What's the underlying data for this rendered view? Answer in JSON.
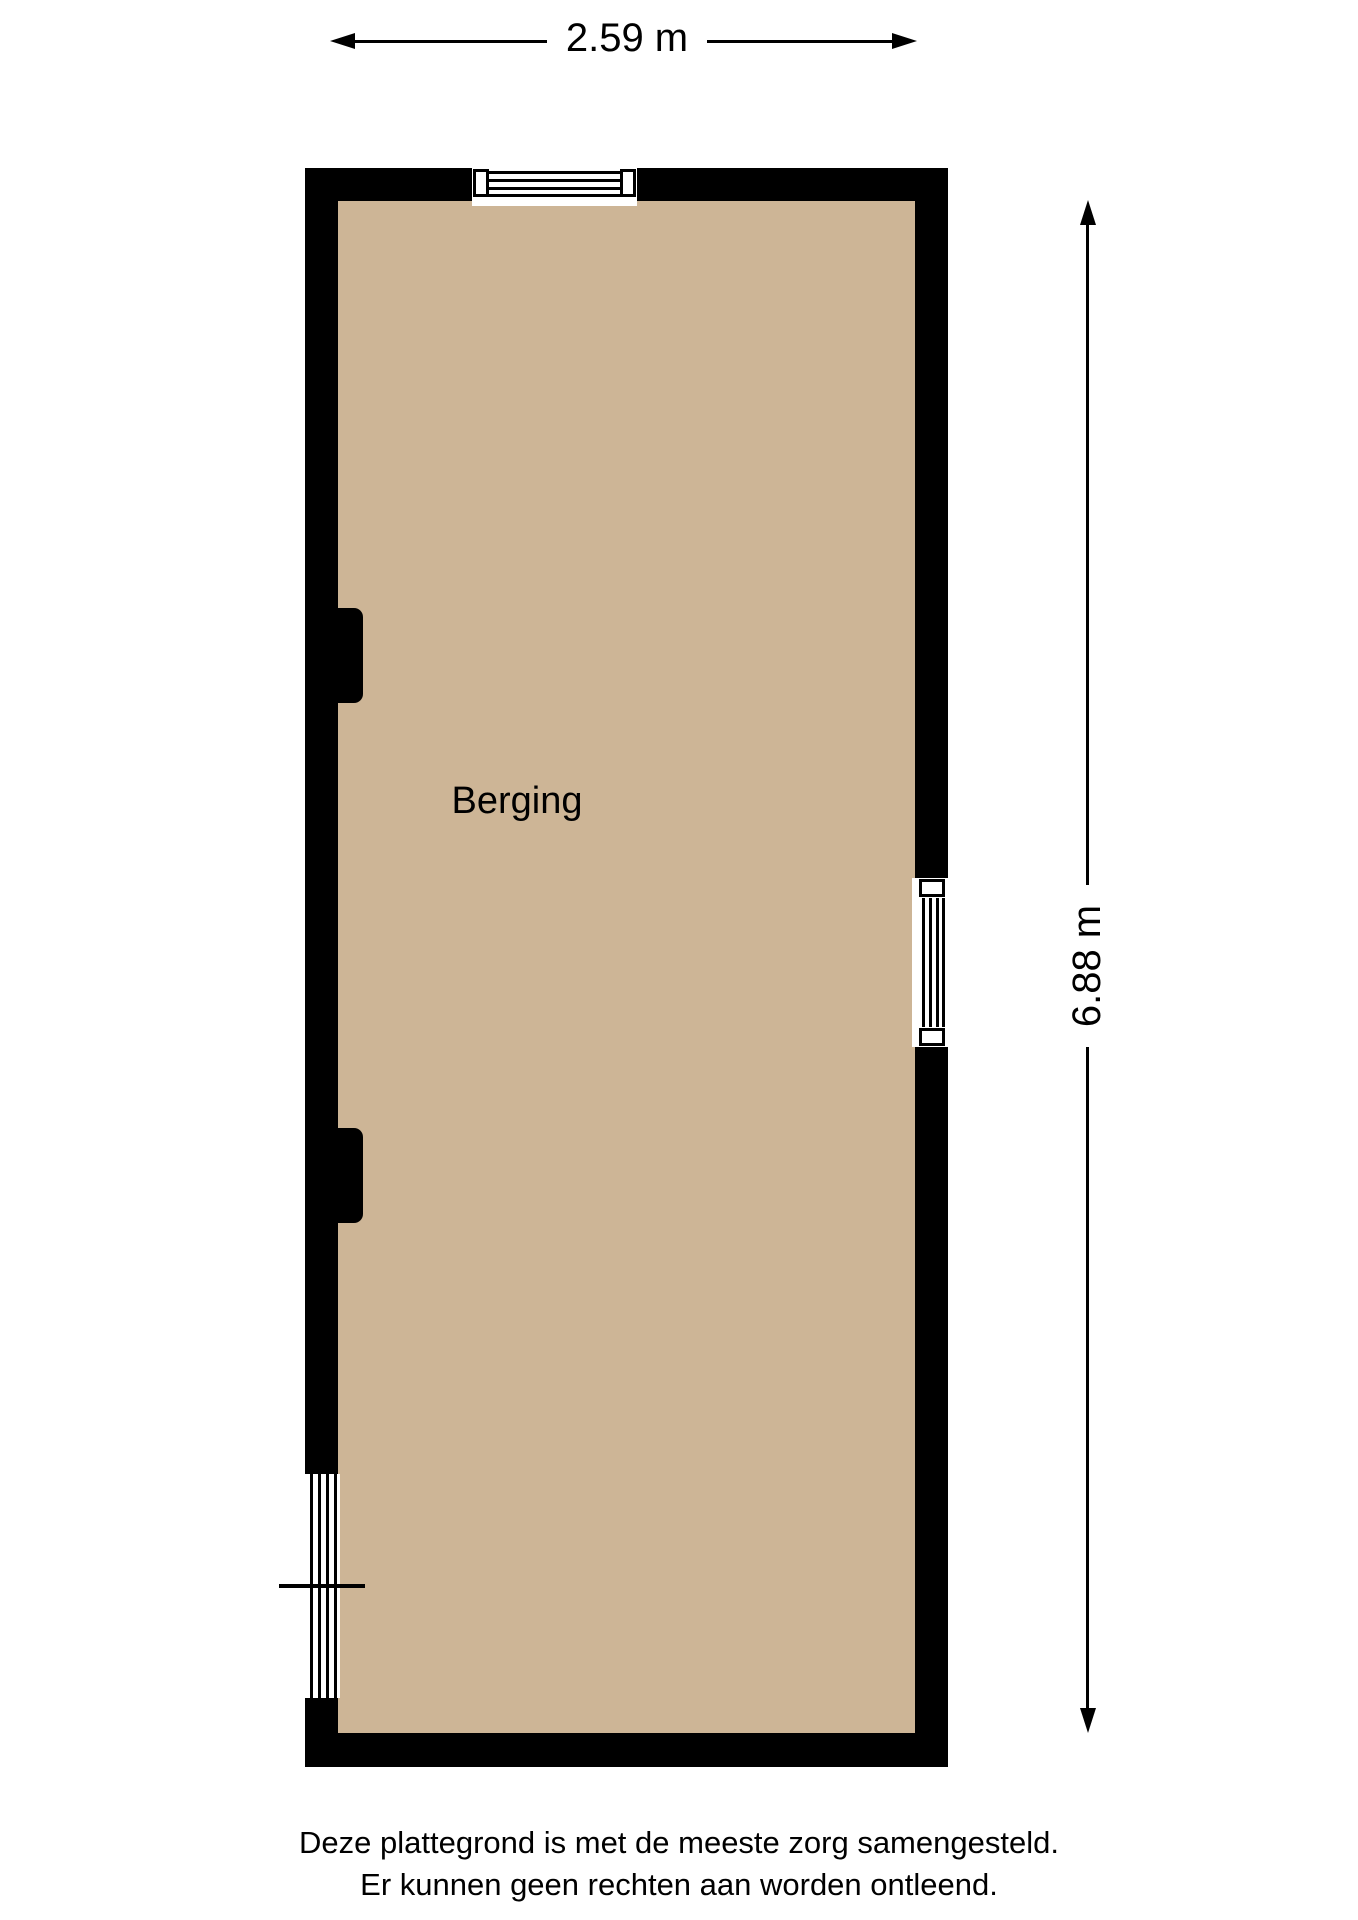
{
  "dimensions": {
    "width_label": "2.59 m",
    "height_label": "6.88 m"
  },
  "room": {
    "label": "Berging"
  },
  "footer": {
    "line1": "Deze plattegrond is met de meeste zorg samengesteld.",
    "line2": "Er kunnen geen rechten aan worden ontleend."
  },
  "colors": {
    "wall": "#000000",
    "floor": "#cdb596",
    "background": "#ffffff",
    "ink": "#000000"
  }
}
